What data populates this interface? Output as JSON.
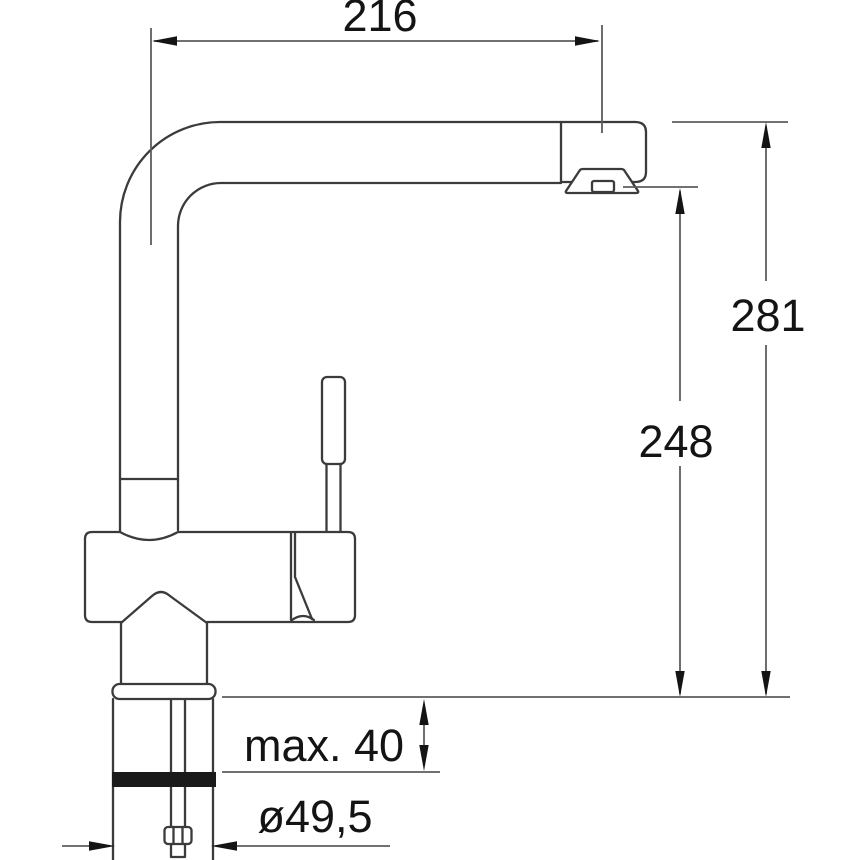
{
  "drawing": {
    "dimensions": {
      "spout_reach": "216",
      "overall_height": "281",
      "outlet_height": "248",
      "max_mounting_thickness": "max. 40",
      "hole_diameter": "ø49,5"
    },
    "colors": {
      "background": "#ffffff",
      "outline": "#3b3b3b",
      "dimension_lines": "#5d5d5d",
      "text": "#141414",
      "seal_band": "#1a1a1a"
    }
  }
}
